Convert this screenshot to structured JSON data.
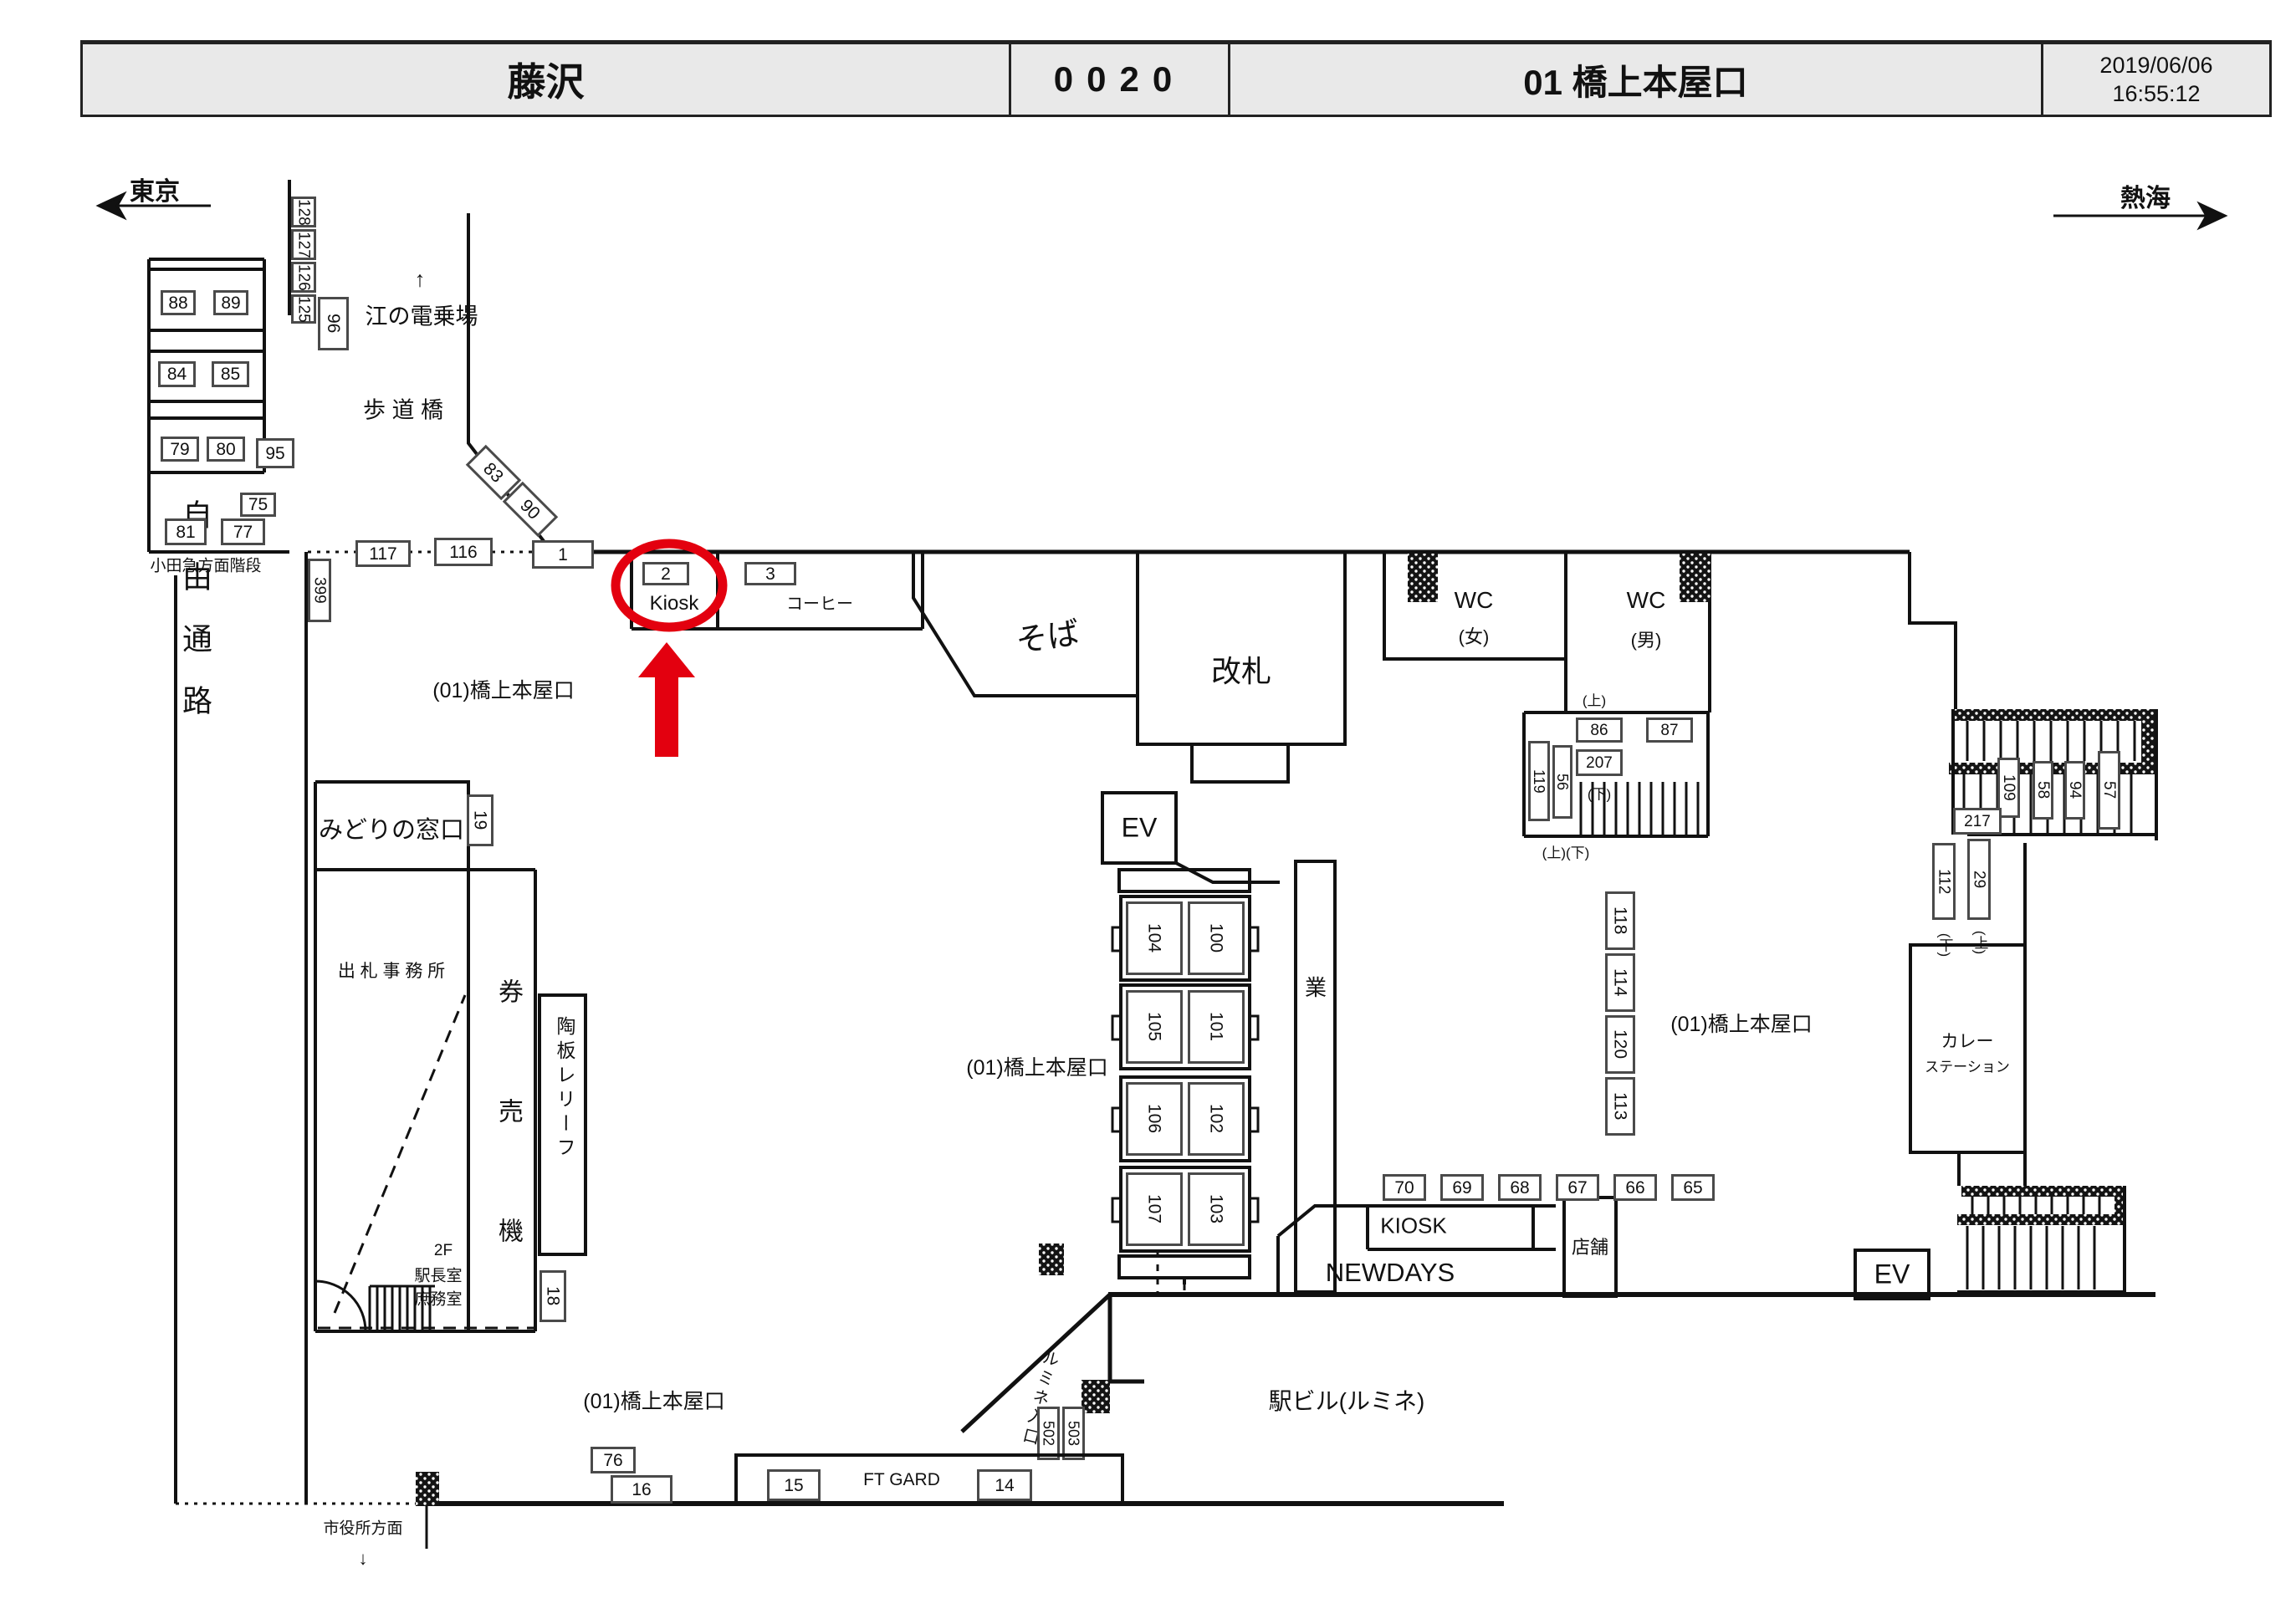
{
  "header": {
    "station": "藤沢",
    "code": "0020",
    "view": "01 橋上本屋口",
    "date": "2019/06/06",
    "time": "16:55:12"
  },
  "compass": {
    "left": "東京",
    "right": "熱海"
  },
  "annotation": {
    "selected_camera": "2",
    "color": "#e3000f"
  },
  "labels": {
    "up_arrow": "↑",
    "enoden": "江の電乗場",
    "hodokyo": "歩 道 橋",
    "odakyu_stairs": "小田急方面階段",
    "jiyu_tsuro": "自由通路",
    "bridge_label": "(01)橋上本屋口",
    "kiosk": "Kiosk",
    "coffee": "コーヒー",
    "soba": "そば",
    "kaisatsu": "改札",
    "wc": "WC",
    "women": "(女)",
    "men": "(男)",
    "ev": "EV",
    "midori": "みどりの窓口",
    "shussatsu": "出 札 事 務 所",
    "kenbaiki": "券 売 機",
    "toban": "陶板レリーフ",
    "f2": "2F",
    "ekicho": "駅長室",
    "shomu": "庶務室",
    "gyo": "業",
    "ue": "(上)",
    "shita": "(下)",
    "ueshita": "(上)(下)",
    "newdays": "NEWDAYS",
    "kiosk2": "KIOSK",
    "tenpo": "店舗",
    "curry1": "カレー",
    "curry2": "ステーション",
    "ekibiru": "駅ビル(ルミネ)",
    "lumine_in": "ルミネ入口",
    "gift": "FT GARD",
    "shiyakusho": "市役所方面",
    "down_arrow": "↓"
  },
  "cam": {
    "1": "1",
    "2": "2",
    "3": "3",
    "14": "14",
    "15": "15",
    "16": "16",
    "18": "18",
    "19": "19",
    "29": "29",
    "56": "56",
    "57": "57",
    "58": "58",
    "65": "65",
    "66": "66",
    "67": "67",
    "68": "68",
    "69": "69",
    "70": "70",
    "75": "75",
    "76": "76",
    "77": "77",
    "79": "79",
    "80": "80",
    "81": "81",
    "83": "83",
    "84": "84",
    "85": "85",
    "86": "86",
    "87": "87",
    "88": "88",
    "89": "89",
    "90": "90",
    "94": "94",
    "95": "95",
    "96": "96",
    "100": "100",
    "101": "101",
    "102": "102",
    "103": "103",
    "104": "104",
    "105": "105",
    "106": "106",
    "107": "107",
    "109": "109",
    "112": "112",
    "113": "113",
    "114": "114",
    "116": "116",
    "117": "117",
    "118": "118",
    "119": "119",
    "120": "120",
    "125": "125",
    "126": "126",
    "127": "127",
    "128": "128",
    "207": "207",
    "217": "217",
    "399": "399",
    "502": "502",
    "503": "503"
  }
}
